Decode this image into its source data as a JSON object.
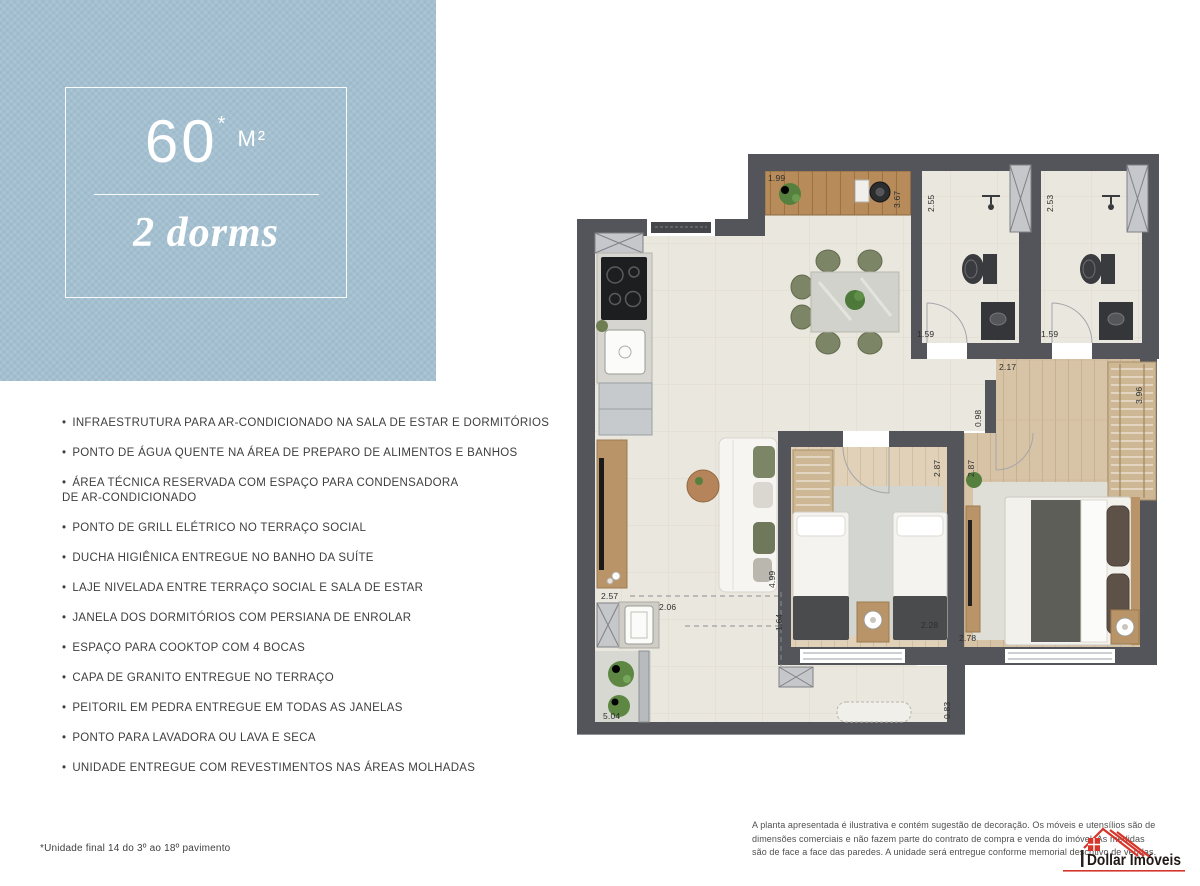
{
  "unit_card": {
    "area_value": "60",
    "area_asterisk": "*",
    "area_unit": "M²",
    "dorms_label": "2 dorms"
  },
  "features": {
    "items": [
      "INFRAESTRUTURA PARA AR-CONDICIONADO NA SALA DE ESTAR E DORMITÓRIOS",
      "PONTO DE ÁGUA QUENTE NA ÁREA DE PREPARO DE ALIMENTOS E BANHOS",
      "ÁREA TÉCNICA RESERVADA COM ESPAÇO PARA CONDENSADORA\nDE AR-CONDICIONADO",
      "PONTO DE GRILL ELÉTRICO NO TERRAÇO SOCIAL",
      "DUCHA HIGIÊNICA ENTREGUE NO BANHO DA SUÍTE",
      "LAJE NIVELADA ENTRE TERRAÇO SOCIAL E SALA DE ESTAR",
      "JANELA DOS DORMITÓRIOS COM PERSIANA DE ENROLAR",
      "ESPAÇO PARA COOKTOP COM 4 BOCAS",
      "CAPA DE GRANITO ENTREGUE NO TERRAÇO",
      "PEITORIL EM PEDRA ENTREGUE EM TODAS AS JANELAS",
      "PONTO PARA LAVADORA OU LAVA E SECA",
      "UNIDADE ENTREGUE COM REVESTIMENTOS NAS ÁREAS MOLHADAS"
    ]
  },
  "footnote": "*Unidade final 14 do 3º ao 18º pavimento",
  "disclaimer": {
    "lines": [
      "A planta apresentada é ilustrativa e contém sugestão de decoração. Os móveis e utensílios são de",
      "dimensões comerciais e não fazem parte do contrato de compra e venda do imóvel. As medidas",
      "são de face a face das paredes. A unidade será entregue conforme memorial descritivo de vendas."
    ]
  },
  "logo": {
    "name": "Dollar Imóveis"
  },
  "colors": {
    "card_blue": "#a4c0d0",
    "wall_gray": "#54555a",
    "floor_beige": "#eae7de",
    "wood": "#d7c3a6",
    "logo_red": "#d6352b"
  },
  "floor_plan": {
    "dimensions": [
      {
        "value": "1.99",
        "x": 193,
        "y": 23,
        "rot": "h"
      },
      {
        "value": "3.67",
        "x": 317,
        "y": 58,
        "rot": "v"
      },
      {
        "value": "2.55",
        "x": 351,
        "y": 62,
        "rot": "v"
      },
      {
        "value": "2.53",
        "x": 470,
        "y": 62,
        "rot": "v"
      },
      {
        "value": "1.59",
        "x": 342,
        "y": 179,
        "rot": "h"
      },
      {
        "value": "1.59",
        "x": 466,
        "y": 179,
        "rot": "h"
      },
      {
        "value": "2.17",
        "x": 424,
        "y": 212,
        "rot": "h"
      },
      {
        "value": "0.98",
        "x": 398,
        "y": 277,
        "rot": "v"
      },
      {
        "value": "3.96",
        "x": 559,
        "y": 254,
        "rot": "v"
      },
      {
        "value": "2.87",
        "x": 357,
        "y": 327,
        "rot": "v"
      },
      {
        "value": "2.87",
        "x": 391,
        "y": 327,
        "rot": "v"
      },
      {
        "value": "4.99",
        "x": 192,
        "y": 438,
        "rot": "v"
      },
      {
        "value": "2.57",
        "x": 26,
        "y": 441,
        "rot": "h"
      },
      {
        "value": "2.06",
        "x": 84,
        "y": 452,
        "rot": "h"
      },
      {
        "value": "1.64",
        "x": 199,
        "y": 481,
        "rot": "v"
      },
      {
        "value": "2.28",
        "x": 346,
        "y": 470,
        "rot": "h"
      },
      {
        "value": "2.78",
        "x": 384,
        "y": 483,
        "rot": "h"
      },
      {
        "value": "5.04",
        "x": 28,
        "y": 561,
        "rot": "h"
      },
      {
        "value": "0.83",
        "x": 367,
        "y": 569,
        "rot": "v"
      }
    ]
  }
}
